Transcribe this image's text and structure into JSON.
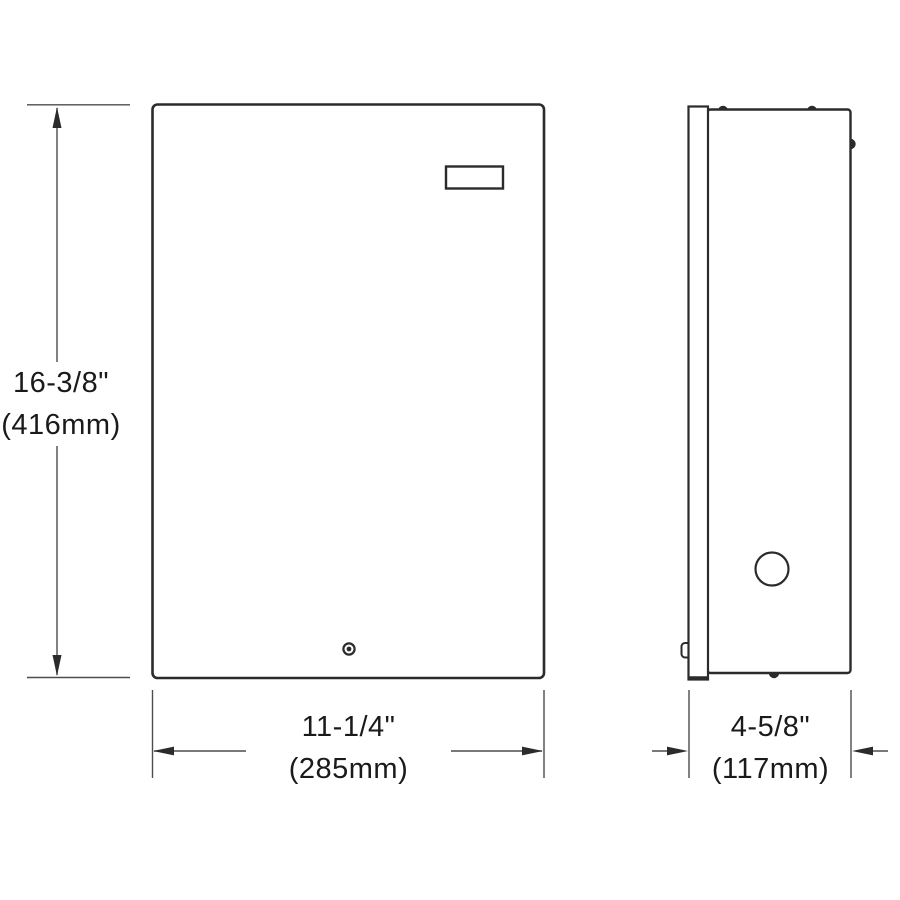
{
  "drawing": {
    "type": "technical-dimension-drawing",
    "views": {
      "front": "front-view",
      "side": "side-view"
    },
    "colors": {
      "outline": "#2b2b2b",
      "dimension_line": "#4d4d4d",
      "text": "#1a1a1a",
      "background": "#ffffff"
    },
    "dimensions": {
      "height": {
        "inches": "16-3/8\"",
        "mm": "(416mm)"
      },
      "width": {
        "inches": "11-1/4\"",
        "mm": "(285mm)"
      },
      "depth": {
        "inches": "4-5/8\"",
        "mm": "(117mm)"
      }
    }
  }
}
